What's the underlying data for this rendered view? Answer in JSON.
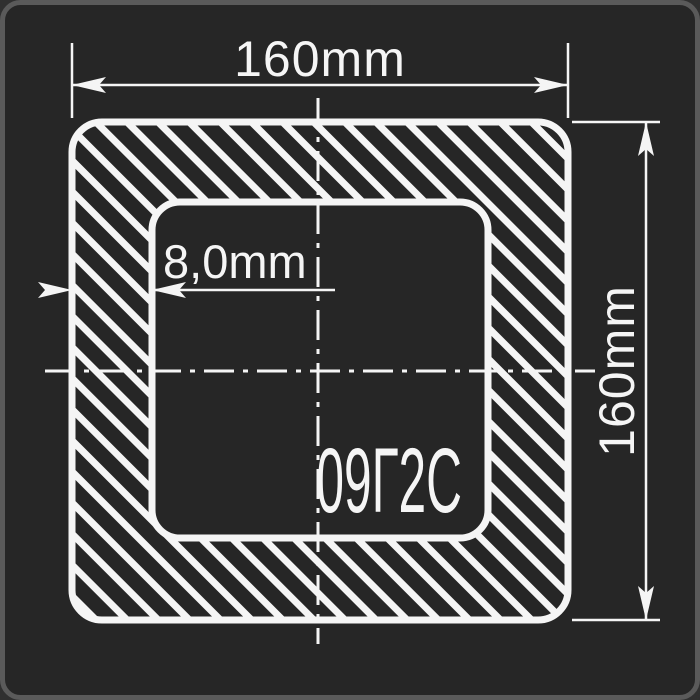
{
  "drawing": {
    "type_label": "square-tube-cross-section",
    "material_label": "09Г2С",
    "dimensions": {
      "width_label": "160mm",
      "height_label": "160mm",
      "wall_thickness_label": "8,0mm"
    }
  },
  "colors": {
    "line": "#f5f5f5",
    "background": "#262626",
    "frame_border": "#5a5a5a",
    "page_background": "#303030"
  }
}
